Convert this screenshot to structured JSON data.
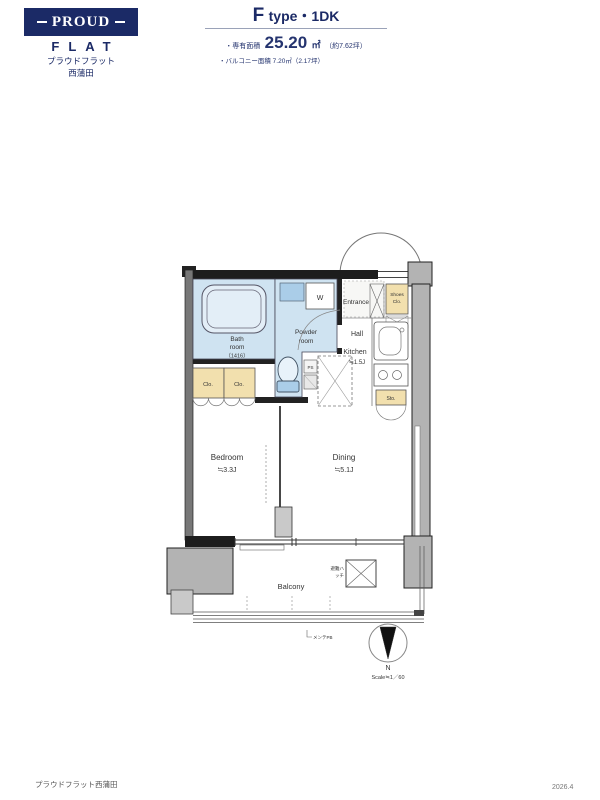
{
  "header": {
    "logo": {
      "proud": "PROUD",
      "flat": "FLAT",
      "brand_jp": "プラウドフラット",
      "location_jp": "西蒲田"
    },
    "unit": {
      "type_f": "F",
      "type_rest": "type・1DK",
      "area_label": "・専有面積",
      "area_value": "25.20",
      "area_unit": "㎡",
      "area_tsubo": "（約7.62坪）",
      "balcony_label": "・バルコニー面積 7.20㎡（2.17坪）"
    }
  },
  "plan": {
    "bathroom": {
      "line1": "Bath",
      "line2": "room",
      "size": "（1416）"
    },
    "powder": {
      "line1": "Powder",
      "line2": "room"
    },
    "washer": "W",
    "entrance": "Entrance",
    "shoes": {
      "line1": "Shoes",
      "line2": "Clo."
    },
    "hall": "Hall",
    "kitchen": {
      "label": "Kitchen",
      "size": "≒1.5J"
    },
    "closet_left": "Clo.",
    "closet_right": "Clo.",
    "ps": "PS",
    "storage": "Sto.",
    "bedroom": {
      "label": "Bedroom",
      "size": "≒3.3J"
    },
    "dining": {
      "label": "Dining",
      "size": "≒5.1J"
    },
    "balcony": "Balcony",
    "hatch": {
      "line1": "避難ハ",
      "line2": "ッチ"
    },
    "balcony_note": "メンテPB",
    "compass": {
      "n": "N",
      "scale": "Scale≒1／60"
    }
  },
  "footer": {
    "project": "プラウドフラット西蒲田",
    "date": "2026.4"
  },
  "colors": {
    "brand_navy": "#1b2a66",
    "room_blue": "#cfe3f1",
    "closet_tan": "#f2e0ae",
    "wall_gray": "#b3b3b3"
  }
}
